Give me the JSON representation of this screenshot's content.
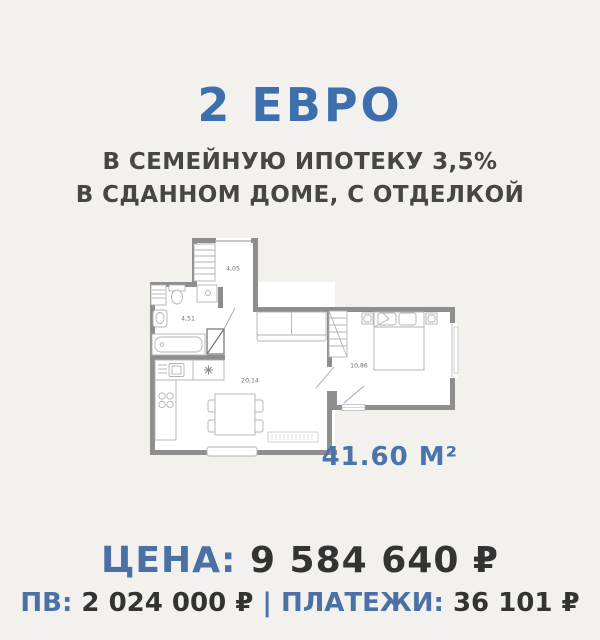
{
  "header": {
    "title": "2 ЕВРО",
    "subtitle_line1": "В СЕМЕЙНУЮ ИПОТЕКУ 3,5%",
    "subtitle_line2": "В СДАННОМ ДОМЕ, С ОТДЕЛКОЙ"
  },
  "floorplan": {
    "rooms": [
      {
        "name": "hallway",
        "area_label": "4,05"
      },
      {
        "name": "bathroom",
        "area_label": "4,51"
      },
      {
        "name": "kitchen-living-room",
        "area_label": "20,14"
      },
      {
        "name": "bedroom",
        "area_label": "10,86"
      }
    ],
    "total_area": "41.60 М²"
  },
  "pricing": {
    "price_label": "ЦЕНА:",
    "price_value": "9 584 640 ₽",
    "downpayment_label": "ПВ:",
    "downpayment_value": "2 024 000 ₽",
    "separator": "|",
    "payment_label": "ПЛАТЕЖИ:",
    "payment_value": "36 101 ₽"
  },
  "colors": {
    "accent_blue": "#3e6fad",
    "text_dark": "#333333",
    "wall_gray": "#8e8e8e",
    "background": "#f2f1ee"
  }
}
